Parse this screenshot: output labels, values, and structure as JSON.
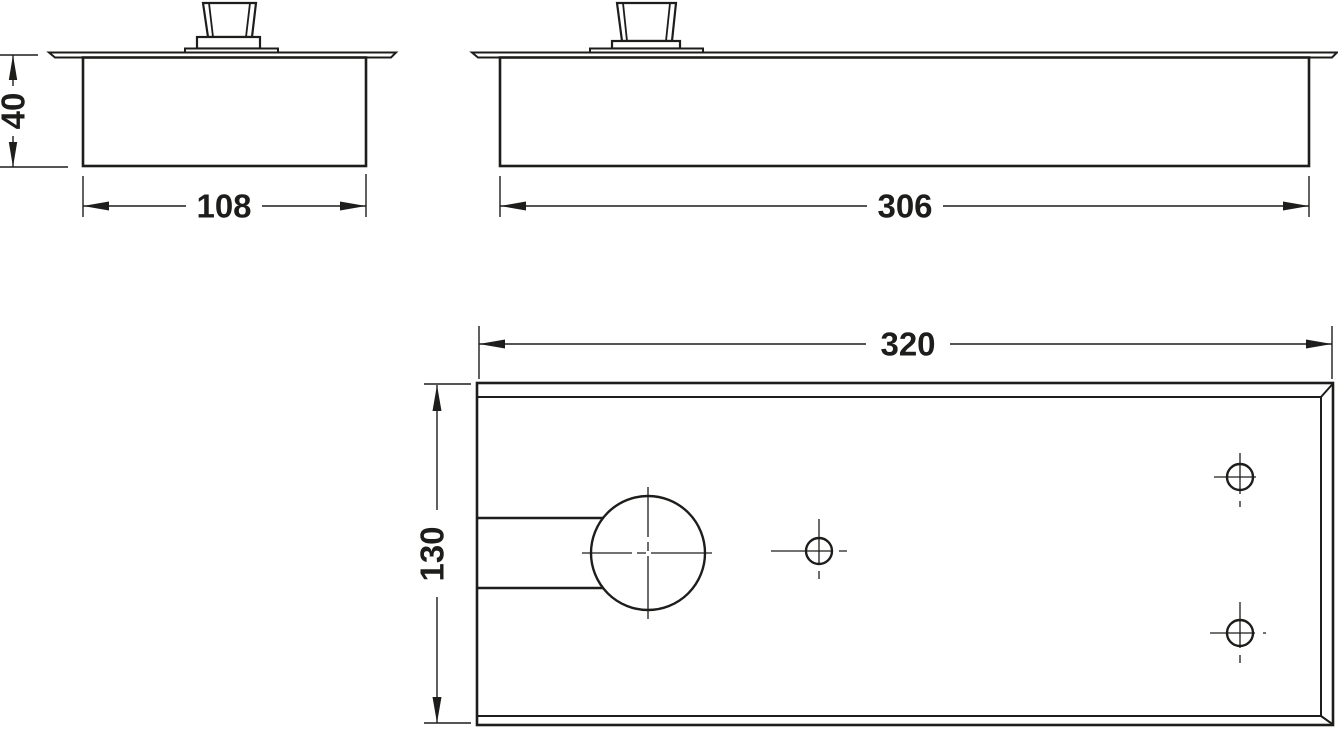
{
  "drawing": {
    "background_color": "#ffffff",
    "line_color": "#1d1d1b",
    "views": {
      "end_view": {
        "name": "end-view",
        "height_dim_label": "40",
        "width_dim_label": "108"
      },
      "front_view": {
        "name": "front-view",
        "length_dim_label": "306"
      },
      "plan_view": {
        "name": "plan-view",
        "length_dim_label": "320",
        "depth_dim_label": "130"
      }
    }
  }
}
